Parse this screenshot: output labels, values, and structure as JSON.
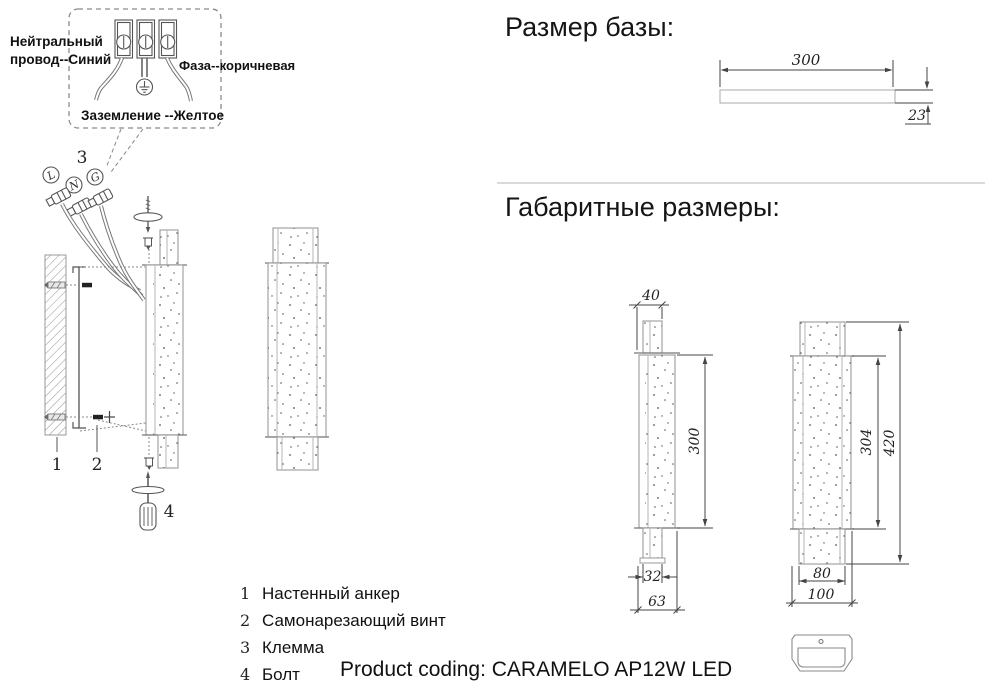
{
  "wiring_box": {
    "neutral_label": "Нейтральный провод--Синий",
    "phase_label": "Фаза--коричневая",
    "ground_label": "Заземление --Желтое",
    "terminals": {
      "l": "L",
      "n": "N",
      "g": "G"
    }
  },
  "callouts": {
    "wall_anchor": "1",
    "screw": "2",
    "terminal": "3",
    "bolt": "4"
  },
  "legend": [
    {
      "num": "1",
      "label": "Настенный анкер"
    },
    {
      "num": "2",
      "label": "Самонарезающий винт"
    },
    {
      "num": "3",
      "label": "Клемма"
    },
    {
      "num": "4",
      "label": "Болт"
    }
  ],
  "sections": {
    "base_size": "Размер базы:",
    "overall_size": "Габаритные размеры:"
  },
  "dims": {
    "base_width": "300",
    "base_thickness": "23",
    "side_top": "40",
    "side_height": "300",
    "side_tube": "32",
    "side_base": "63",
    "front_body": "304",
    "front_total": "420",
    "front_tube": "80",
    "front_base": "100"
  },
  "footer": {
    "product_coding": "Product coding: CARAMELO AP12W LED"
  }
}
